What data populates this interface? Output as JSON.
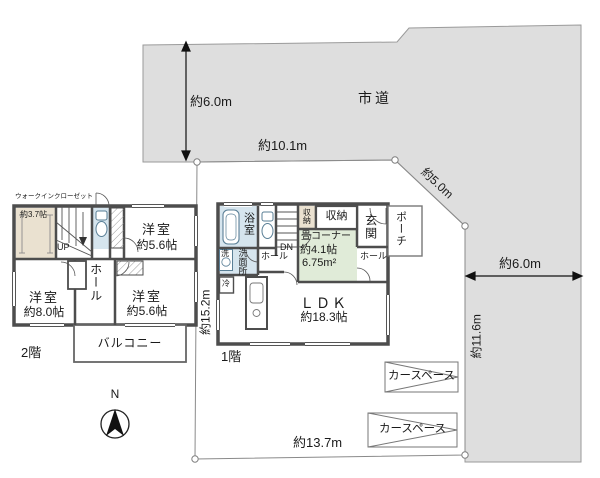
{
  "site": {
    "road_label": "市道",
    "compass": "N",
    "dims": {
      "top_left": "約6.0m",
      "top": "約10.1m",
      "diagonal": "約5.0m",
      "right": "約6.0m",
      "right_side": "約11.6m",
      "left_side": "約15.2m",
      "bottom": "約13.7m"
    },
    "car_spaces": [
      "カースペース",
      "カースペース"
    ]
  },
  "floor2": {
    "label": "2階",
    "wic_name": "ウォークインクローゼット",
    "wic_size": "約3.7帖",
    "up": "UP",
    "bedroom_ne": {
      "name": "洋室",
      "size": "約5.6帖"
    },
    "bedroom_sw": {
      "name": "洋室",
      "size": "約8.0帖"
    },
    "bedroom_se": {
      "name": "洋室",
      "size": "約5.6帖"
    },
    "hall": "ホール",
    "balcony": "バルコニー"
  },
  "floor1": {
    "label": "1階",
    "bath": "浴室",
    "laundry": "洗",
    "washroom": "洗面所",
    "dn": "DN",
    "dn_hall": "ホール",
    "storage_small": "収納",
    "storage_wide": "収納",
    "entrance": "玄関",
    "porch": "ポーチ",
    "hall": "ホール",
    "fridge": "冷",
    "tatami": {
      "name": "畳コーナー",
      "size": "約4.1帖",
      "area": "6.75m²"
    },
    "ldk": {
      "name": "ＬＤＫ",
      "size": "約18.3帖"
    }
  },
  "colors": {
    "road": "#dedede",
    "wall": "#4d4d4d",
    "wet_room": "#d6e5ee",
    "tatami_room": "#e0ebd8",
    "closet_beige": "#eae1d0"
  }
}
